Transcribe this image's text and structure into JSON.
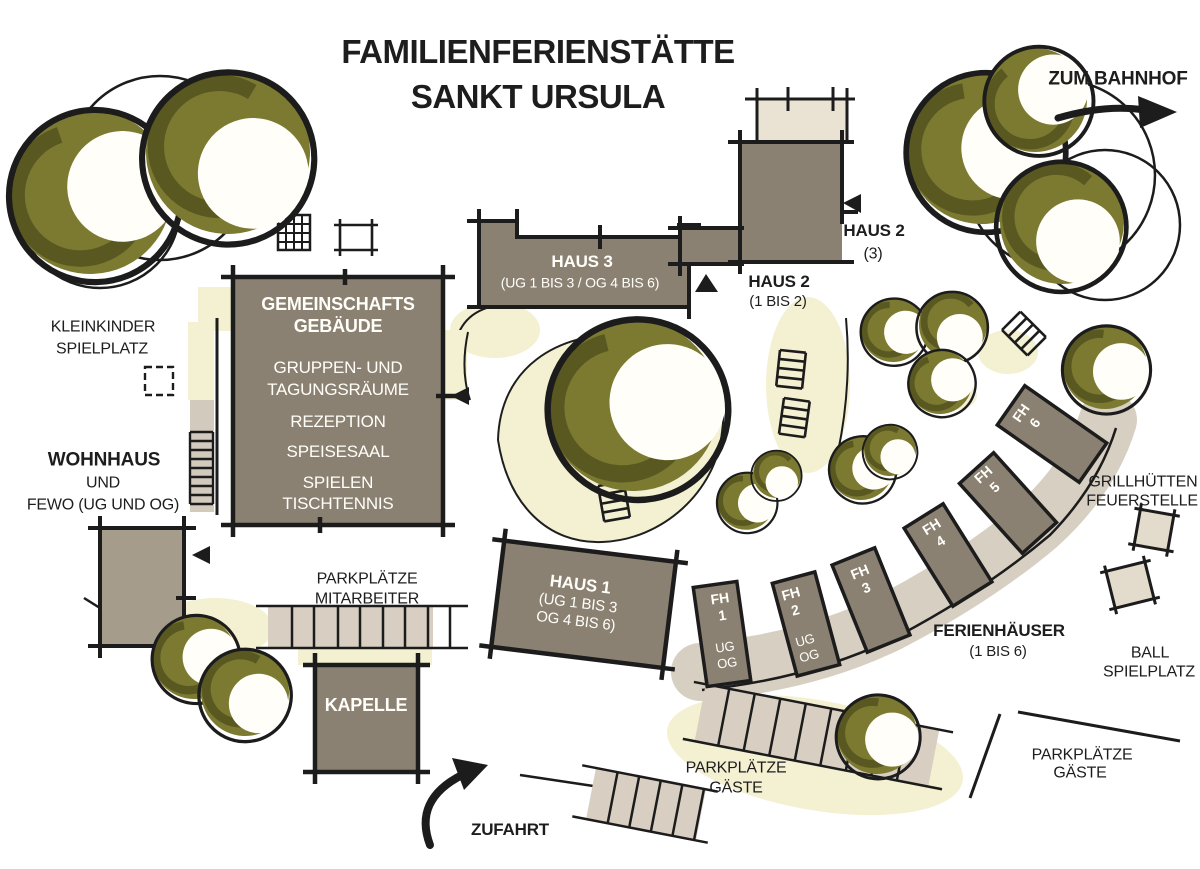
{
  "title": {
    "line1": "FAMILIENFERIENSTÄTTE",
    "line2": "SANKT URSULA"
  },
  "directions": {
    "bahnhof": "ZUM BAHNHOF",
    "zufahrt": "ZUFAHRT"
  },
  "buildings": {
    "gemeinschaft": {
      "name1": "GEMEINSCHAFTS",
      "name2": "GEBÄUDE",
      "rooms": [
        "GRUPPEN- UND",
        "TAGUNGSRÄUME",
        "REZEPTION",
        "SPEISESAAL",
        "SPIELEN",
        "TISCHTENNIS"
      ]
    },
    "haus3": {
      "name": "HAUS 3",
      "floors": "(UG 1 BIS 3 / OG 4 BIS 6)"
    },
    "haus2a": {
      "name": "HAUS 2",
      "floors": "(3)"
    },
    "haus2b": {
      "name": "HAUS 2",
      "floors": "(1 BIS 2)"
    },
    "haus1": {
      "name": "HAUS 1",
      "floors1": "(UG 1 BIS 3",
      "floors2": "OG 4 BIS 6)"
    },
    "kapelle": {
      "name": "KAPELLE"
    },
    "wohnhaus": {
      "name": "WOHNHAUS",
      "line2": "UND",
      "line3": "FEWO (UG UND OG)"
    }
  },
  "ferienhaeuser": {
    "label1": "FERIENHÄUSER",
    "label2": "(1 BIS 6)",
    "units": [
      {
        "name": "FH",
        "num": "1",
        "ug": "UG",
        "og": "OG"
      },
      {
        "name": "FH",
        "num": "2",
        "ug": "UG",
        "og": "OG"
      },
      {
        "name": "FH",
        "num": "3"
      },
      {
        "name": "FH",
        "num": "4"
      },
      {
        "name": "FH",
        "num": "5"
      },
      {
        "name": "FH",
        "num": "6"
      }
    ]
  },
  "areas": {
    "kleinkinder1": "KLEINKINDER",
    "kleinkinder2": "SPIELPLATZ",
    "park_mitarbeiter1": "PARKPLÄTZE",
    "park_mitarbeiter2": "MITARBEITER",
    "park_gaeste_mitte1": "PARKPLÄTZE",
    "park_gaeste_mitte2": "GÄSTE",
    "park_gaeste_rechts1": "PARKPLÄTZE",
    "park_gaeste_rechts2": "GÄSTE",
    "grill1": "GRILLHÜTTEN",
    "grill2": "FEUERSTELLE",
    "ball1": "BALL",
    "ball2": "SPIELPLATZ"
  },
  "colors": {
    "ink": "#1c1c1c",
    "building": "#8b8173",
    "building_light": "#a69c8c",
    "tan": "#d8cfc2",
    "tan_light": "#eae3d4",
    "cream": "#f4f0d2",
    "olive": "#7c7a31",
    "olive_dark": "#54521e",
    "white_text": "#fffef9"
  }
}
